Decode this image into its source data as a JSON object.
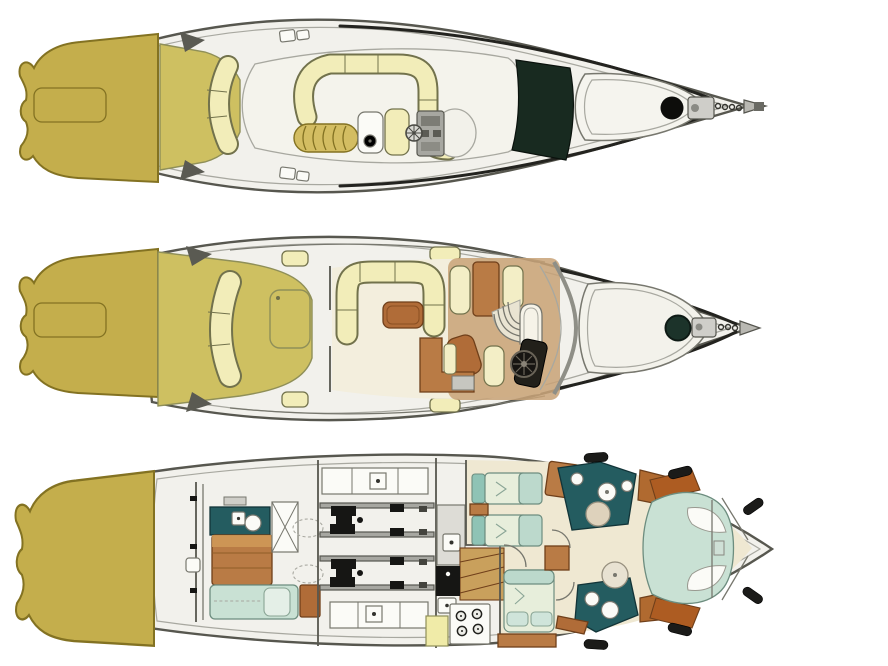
{
  "canvas": {
    "width": 888,
    "height": 666,
    "background": "#ffffff"
  },
  "diagram": {
    "description": "Motor yacht floor plan, three decks stacked vertically, bow pointing right",
    "orientation": "bow-right"
  },
  "colors": {
    "page-bg": "#ffffff",
    "hull-fill": "#f2f1ec",
    "hull-line": "#57574f",
    "line-soft": "#a8a8a0",
    "line-mid": "#77776e",
    "sheer-dark": "#23231f",
    "platform-gold": "#c4ae4c",
    "platform-edge": "#837222",
    "deck-khaki": "#cec061",
    "khaki-edge": "#8f8f58",
    "seat-cream": "#f2edb9",
    "seat-edge": "#72724c",
    "sunpad-gold": "#d3bd62",
    "windshield-dark": "#182a20",
    "saloon-floor": "#f3eedd",
    "carpet-tan": "#c8a277",
    "accom-floor": "#efe8d2",
    "table-brown": "#b06c38",
    "wood-brown": "#b97b45",
    "wood-edge": "#6f3f1a",
    "bed-green": "#c9e1d4",
    "bed-cream": "#e7eedb",
    "bed-foot": "#bcd9cc",
    "pillow-teal": "#8fc3b5",
    "bed-edge": "#6d8d7f",
    "bath-teal": "#245c60",
    "teal-edge": "#123438",
    "console-grey": "#a7a7a1",
    "panel-white": "#fbfbf7",
    "black": "#161614",
    "fender-black": "#1b1b19",
    "hatch-green": "#1c332a",
    "stair-tan": "#c9a05c"
  },
  "decks": {
    "flybridge": {
      "name": "Flybridge deck",
      "features": [
        "swim-platform",
        "transom-seat",
        "c-shaped-settee",
        "ribbed-sunlounger",
        "wet-bar",
        "helm-console",
        "steering-wheel",
        "helm-seat",
        "dark-windscreen",
        "bow-sunpad",
        "foredeck-hatch",
        "anchor-windlass"
      ]
    },
    "main": {
      "name": "Main deck",
      "features": [
        "swim-platform",
        "cockpit",
        "transom-bench",
        "cockpit-table",
        "saloon",
        "u-shaped-sofa",
        "coffee-table",
        "armchair",
        "tv-cabinet",
        "galley",
        "companionway-stairs",
        "arched-door",
        "helm-station",
        "steering-wheel",
        "helm-seat",
        "windscreen",
        "bow-sunpad",
        "foredeck-hatch",
        "anchor-windlass"
      ]
    },
    "lower": {
      "name": "Lower deck",
      "features": [
        "swim-platform",
        "crew-cabin",
        "teal-desk",
        "crew-berth",
        "settee-berth",
        "engine-room",
        "twin-engines",
        "workbenches",
        "galley",
        "stove",
        "sink",
        "staircase",
        "twin-guest-cabin",
        "twin-beds",
        "double-guest-cabin",
        "double-bed",
        "forward-bathroom",
        "aft-bathroom",
        "shower",
        "toilet",
        "washbasin",
        "master-cabin",
        "island-bed",
        "hull-fenders"
      ]
    }
  }
}
